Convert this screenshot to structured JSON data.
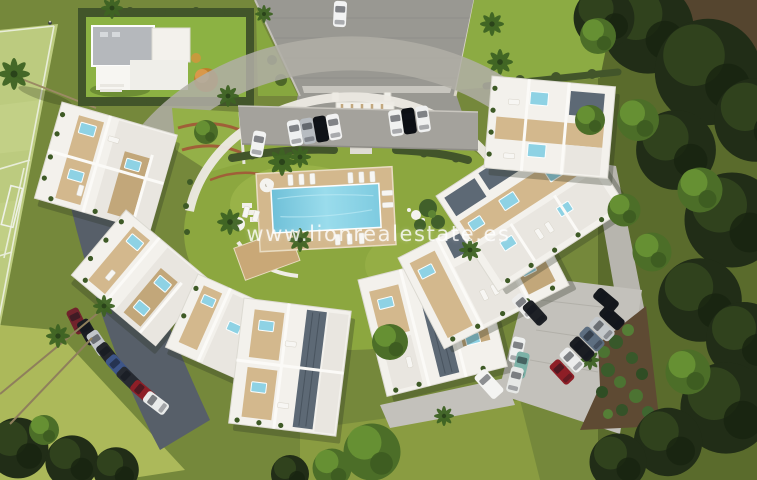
{
  "watermark": {
    "text": "www.lionrealestate.es"
  },
  "palette": {
    "building_white": "#f3f1ec",
    "deck_beige": "#d3b88d",
    "deck_dark": "#c2a77a",
    "slate_panel": "#5d6975",
    "pool_blue": "#8ed2e4",
    "courtyard_green": "#8ca73f",
    "lawn_olive": "#75883b",
    "lawn_dark": "#59692c",
    "lawn_bright": "#93a545",
    "field_green": "#bccb7f",
    "hedge_green": "#42552a",
    "road_gray": "#a4a29c",
    "drive_gray": "#999892",
    "lot_gray": "#c3c1bb",
    "shadow_paving": "#575f69",
    "terracotta_edge": "#a05f38",
    "watermark_color": "rgba(255,255,255,0.8)"
  }
}
